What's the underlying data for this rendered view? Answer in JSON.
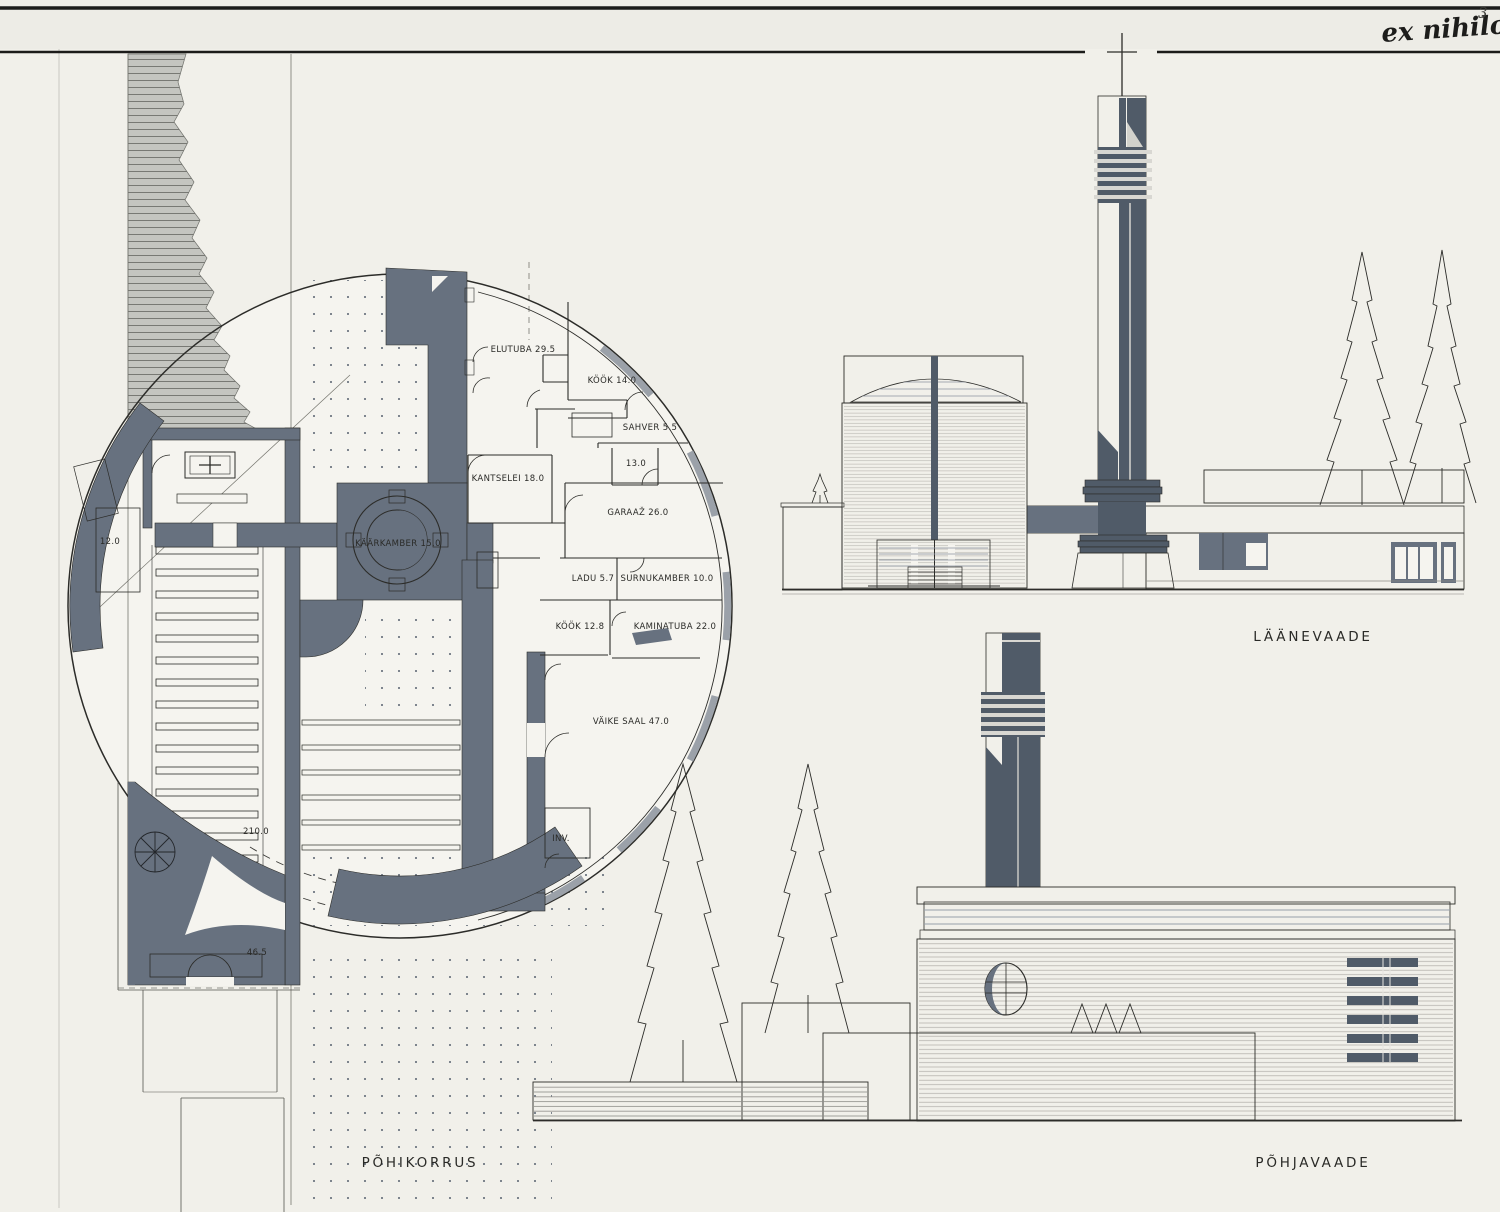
{
  "page": {
    "handwriting": "ex nihilo",
    "number": "3"
  },
  "plan": {
    "caption": "PÕHIKORRUS",
    "rooms": [
      {
        "label": "ELUTUBA 29.5",
        "x": 523,
        "y": 349
      },
      {
        "label": "KÖÖK 14.0",
        "x": 612,
        "y": 380
      },
      {
        "label": "SAHVER 5.5",
        "x": 650,
        "y": 427
      },
      {
        "label": "13.0",
        "x": 636,
        "y": 463
      },
      {
        "label": "KANTSELEI 18.0",
        "x": 508,
        "y": 478
      },
      {
        "label": "GARAAŽ  26.0",
        "x": 638,
        "y": 512
      },
      {
        "label": "KÄÄRKAMBER 15.0",
        "x": 398,
        "y": 543
      },
      {
        "label": "LADU 5.7",
        "x": 593,
        "y": 578
      },
      {
        "label": "SURNUKAMBER 10.0",
        "x": 667,
        "y": 578
      },
      {
        "label": "KÖÖK 12.8",
        "x": 580,
        "y": 626
      },
      {
        "label": "KAMINATUBA 22.0",
        "x": 675,
        "y": 626
      },
      {
        "label": "VÄIKE SAAL 47.0",
        "x": 631,
        "y": 721
      },
      {
        "label": "INV.",
        "x": 561,
        "y": 838
      },
      {
        "label": "12.0",
        "x": 110,
        "y": 541
      },
      {
        "label": "210.0",
        "x": 256,
        "y": 831
      },
      {
        "label": "46.5",
        "x": 257,
        "y": 952
      }
    ]
  },
  "elevations": {
    "west": {
      "caption": "LÄÄNEVAADE"
    },
    "north": {
      "caption": "PÕHJAVAADE"
    }
  },
  "colors": {
    "paper": "#f1f0ea",
    "slate": "#67717f",
    "slate_dark": "#505b68",
    "light": "#d9d8d2",
    "mid": "#c7c7c1",
    "line": "#2c2c29",
    "hatch": "#c4c5c0"
  }
}
